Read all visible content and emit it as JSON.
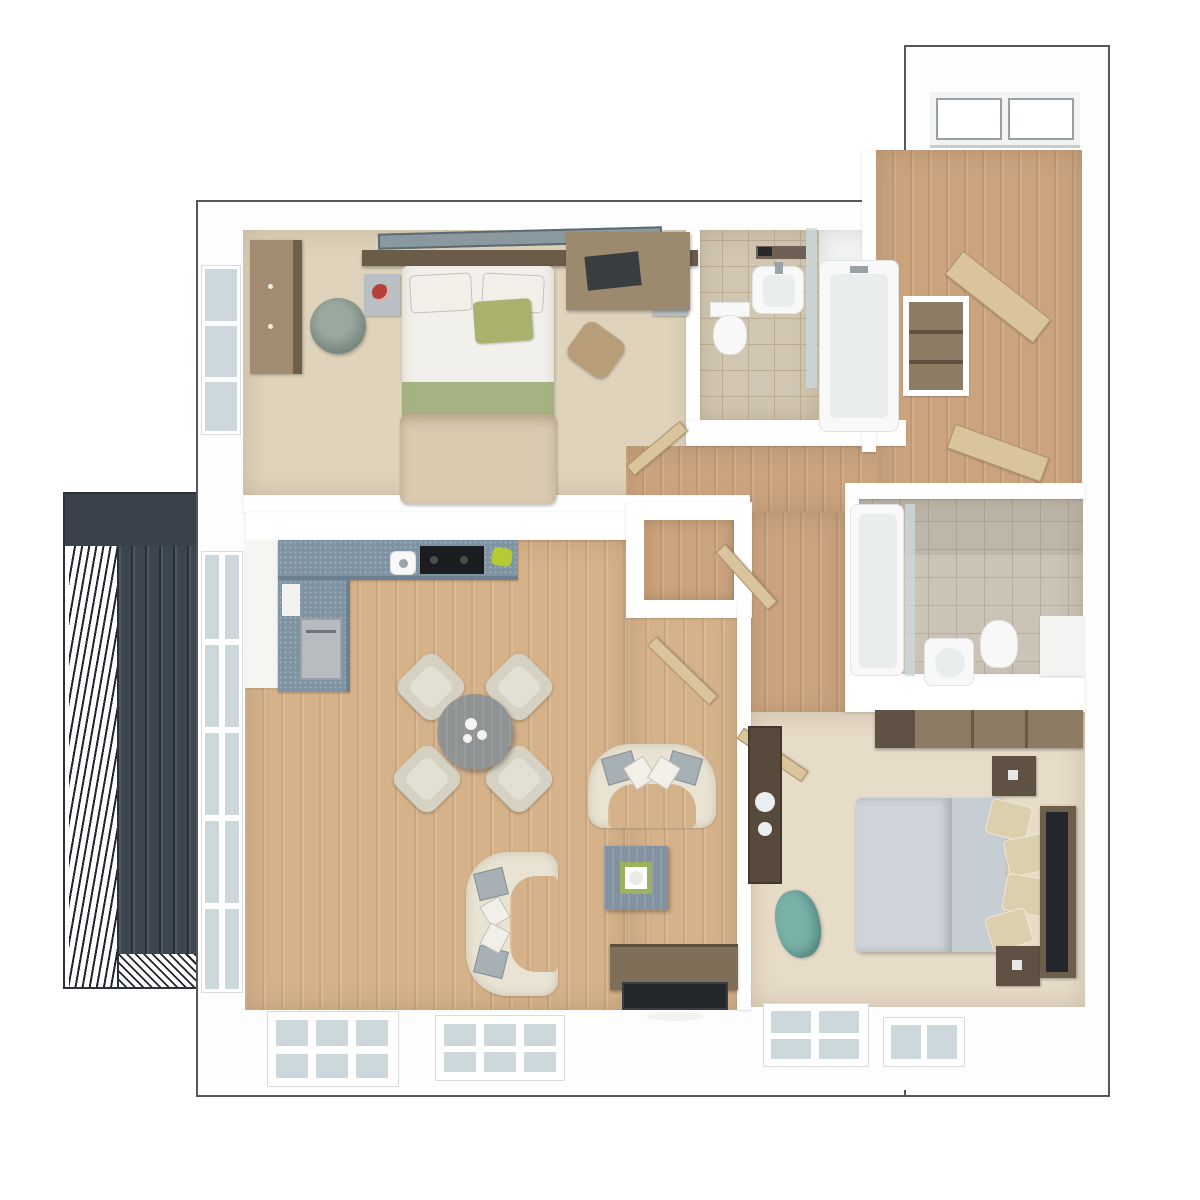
{
  "scene": {
    "type": "3d-floor-plan-render",
    "view": "top-down dollhouse view, no text labels",
    "rooms": [
      "balcony",
      "living-kitchen-dining-room",
      "bedroom-1",
      "bathroom-1",
      "entrance-hall",
      "inner-hallway",
      "storage-cupboard",
      "bathroom-2",
      "bedroom-2"
    ],
    "furniture": [
      "double-bed-1",
      "wardrobe",
      "dressing-stool",
      "desk-with-laptop",
      "desk-chair",
      "toilet-1",
      "basin-1",
      "bathtub-1",
      "l-shaped-kitchen-counter",
      "hob",
      "oven",
      "round-dining-table",
      "dining-chair-x4",
      "curved-sofa-1",
      "curved-sofa-2",
      "coffee-table",
      "tv-unit-with-tv",
      "bathtub-2",
      "basin-2",
      "toilet-2",
      "dresser",
      "double-bed-2",
      "nightstand-x2",
      "wall-tv",
      "laundry-cabinet",
      "beanbag-chair",
      "entrance-double-door",
      "hall-closet"
    ]
  },
  "colors": {
    "outline": "#54585c",
    "slab": "#fdfdfd",
    "wall": "#ffffff",
    "woodHall": "#cba47e",
    "woodLiving": "#d6b28a",
    "carpet1": "#dfd3bb",
    "carpet2": "#e7dcc8",
    "tile1": "#d1c6b1",
    "grout1": "#bcae94",
    "tile2": "#cac3b6",
    "grout2": "#b5ad9f",
    "glass": "#ccd8dc",
    "fixture": "#f7f8f7",
    "fixtureEdge": "#dfe3e1",
    "fixtureIn": "#e9edeb",
    "counter": "#7f94a2",
    "hob": "#1b1d1f",
    "ovenSilver": "#b7bcc0",
    "balconyDark": "#39424c",
    "balconySlat": "#3c4650",
    "sofaCream": "#e9e3d3",
    "cushionGray": "#a7b0b4",
    "pillowWhite": "#f1efe7",
    "doorBeige": "#d9c49c",
    "woodDark": "#5f5244",
    "woodMid": "#8d7b63",
    "woodLight": "#b79d78",
    "deskWood": "#9c8a6e",
    "bedWhite": "#f2f0ea",
    "greenPillow": "#a9b16c",
    "greenThrow": "#9cab76",
    "blanketBeige": "#d9cab0",
    "mattressGray": "#c6cdd3",
    "pillowBeige": "#dbcfad",
    "lampRed": "#b5413a",
    "tealSeat": "#79b1a9",
    "plantGreen": "#b6ca33",
    "tableGray": "#909394",
    "chairFabric": "#d5d1c3",
    "chairInner": "#e2dfd4",
    "tvDark": "#24272b",
    "tvWood": "#7f6e58",
    "coffeeTable": "#8292a0"
  }
}
